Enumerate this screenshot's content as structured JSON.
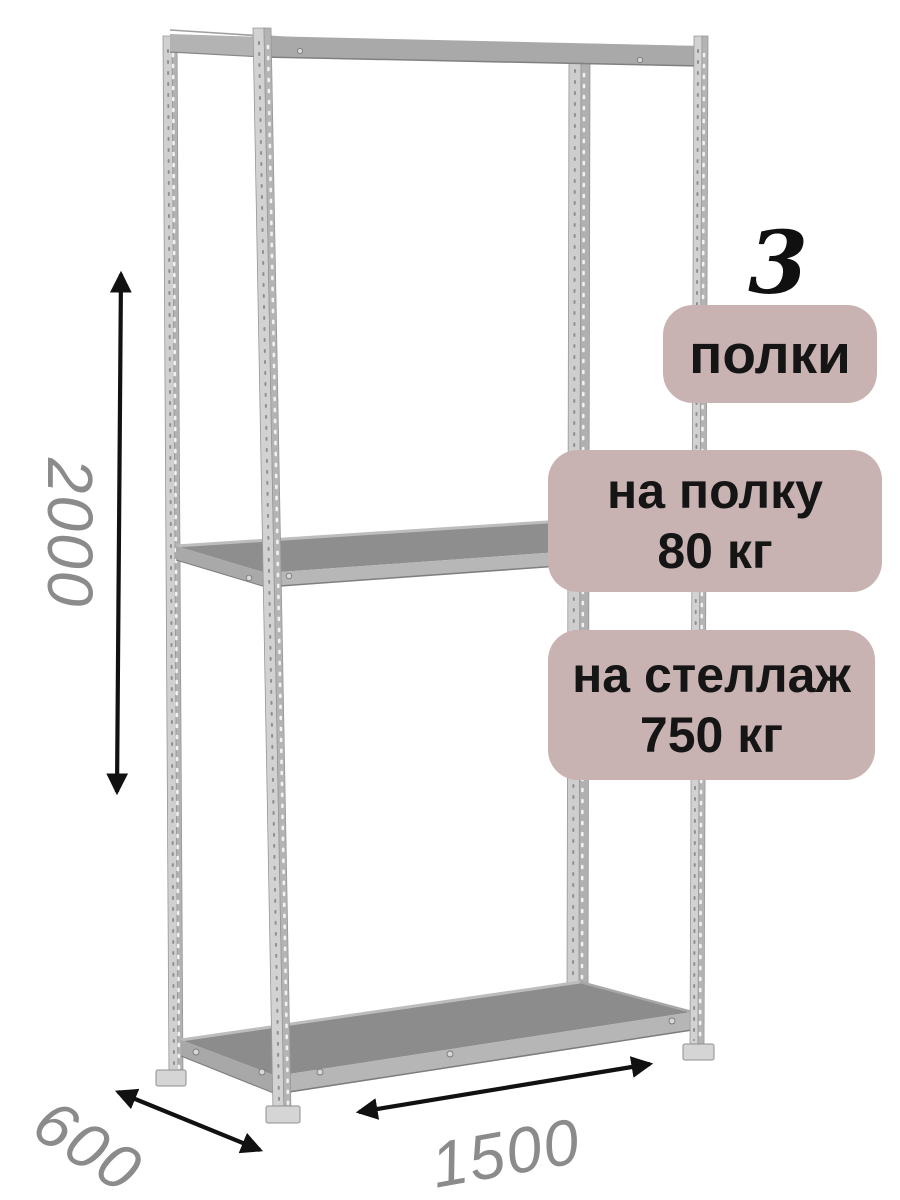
{
  "annotations": {
    "shelf_count": {
      "value": "3",
      "label": "полки"
    },
    "load_per_shelf": {
      "label": "на полку",
      "value": "80 кг"
    },
    "load_per_rack": {
      "label": "на стеллаж",
      "value": "750 кг"
    }
  },
  "dimensions": {
    "height_mm": "2000",
    "depth_mm": "600",
    "width_mm": "1500"
  },
  "illustration": {
    "subject": "металлический стеллаж с 3 полками",
    "shelves_shown": 3,
    "posts_shown": 4
  },
  "colors": {
    "badge_bg": "#c9b3b2",
    "badge_text": "#151515",
    "dimension_text": "#8b8b8b",
    "arrow": "#111111",
    "metal_light": "#d2d2d2",
    "metal_side": "#b2b2b2",
    "shelf_top": "#8d8d8d",
    "shelf_edge": "#b6b6b6"
  }
}
